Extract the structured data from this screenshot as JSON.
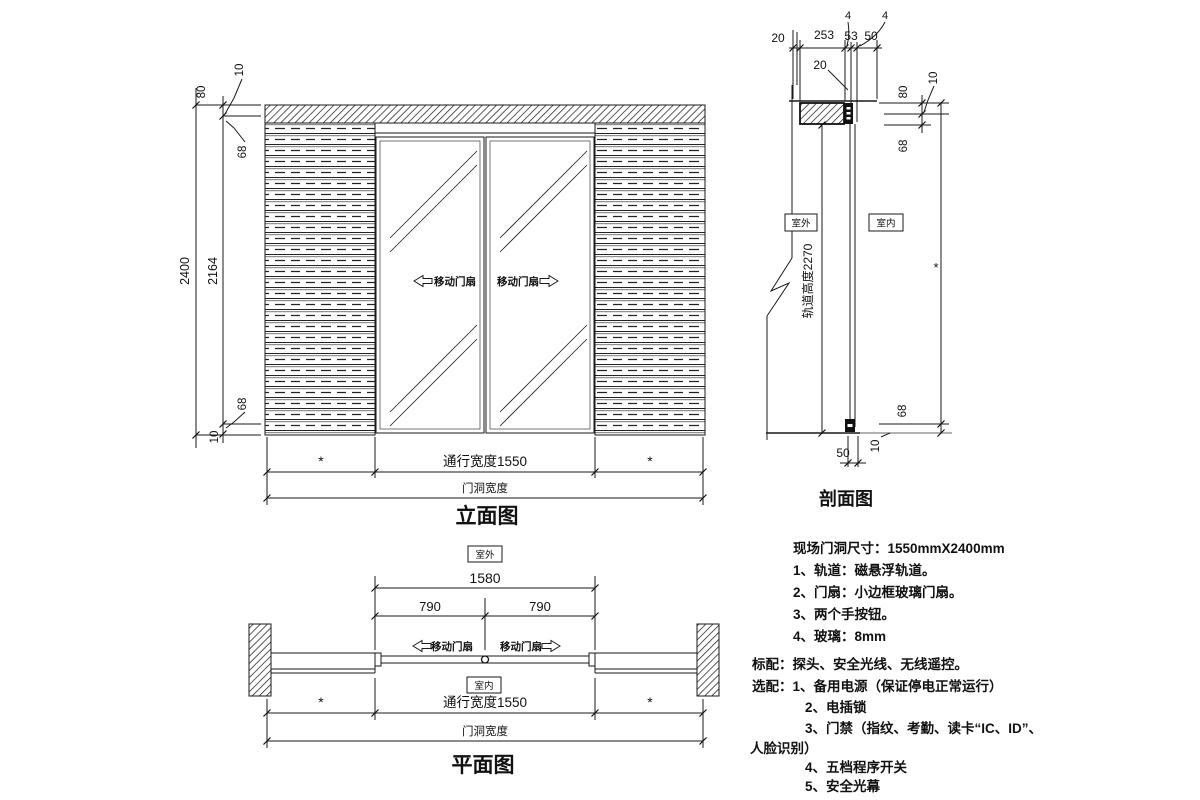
{
  "views": {
    "elevation": {
      "title": "立面图",
      "dim_total_height": "2400",
      "dim_glass_height": "2164",
      "dim_top_track": "80",
      "dim_top_gap": "10",
      "dim_top_rail": "68",
      "dim_bottom_rail": "68",
      "dim_bottom_gap": "10",
      "dim_star_left": "*",
      "dim_passage_width": "通行宽度1550",
      "dim_star_right": "*",
      "dim_opening_width": "门洞宽度",
      "label_leaf_left": "移动门扇",
      "label_leaf_right": "移动门扇"
    },
    "section": {
      "title": "剖面图",
      "dim_top_4a": "4",
      "dim_top_4b": "4",
      "dim_top_20a": "20",
      "dim_top_253": "253",
      "dim_top_53": "53",
      "dim_top_50": "50",
      "dim_top_20b": "20",
      "dim_right_80": "80",
      "dim_right_10_top": "10",
      "dim_right_68_top": "68",
      "dim_right_star": "*",
      "dim_right_68_bottom": "68",
      "dim_right_10_bottom": "10",
      "dim_bottom_50": "50",
      "label_height": "轨道高度2270",
      "label_outside": "室外",
      "label_inside": "室内"
    },
    "plan": {
      "title": "平面图",
      "dim_1580": "1580",
      "dim_790_left": "790",
      "dim_790_right": "790",
      "dim_star_left": "*",
      "dim_passage_width": "通行宽度1550",
      "dim_star_right": "*",
      "dim_opening_width": "门洞宽度",
      "label_leaf_left": "移动门扇",
      "label_leaf_right": "移动门扇",
      "label_outside": "室外",
      "label_inside": "室内"
    }
  },
  "notes": {
    "site_size": "现场门洞尺寸：1550mmX2400mm",
    "spec_items": [
      "1、轨道：磁悬浮轨道。",
      "2、门扇：小边框玻璃门扇。",
      "3、两个手按钮。",
      "4、玻璃：8mm"
    ],
    "standard": "标配：探头、安全光线、无线遥控。",
    "optional_head": "选配：1、备用电源（保证停电正常运行）",
    "optional_items": [
      "2、电插锁",
      "3、门禁（指纹、考勤、读卡“IC、ID”、",
      "人脸识别）",
      "4、五档程序开关",
      "5、安全光幕"
    ]
  },
  "colors": {
    "line": "#1a1a1a",
    "background": "#ffffff"
  }
}
